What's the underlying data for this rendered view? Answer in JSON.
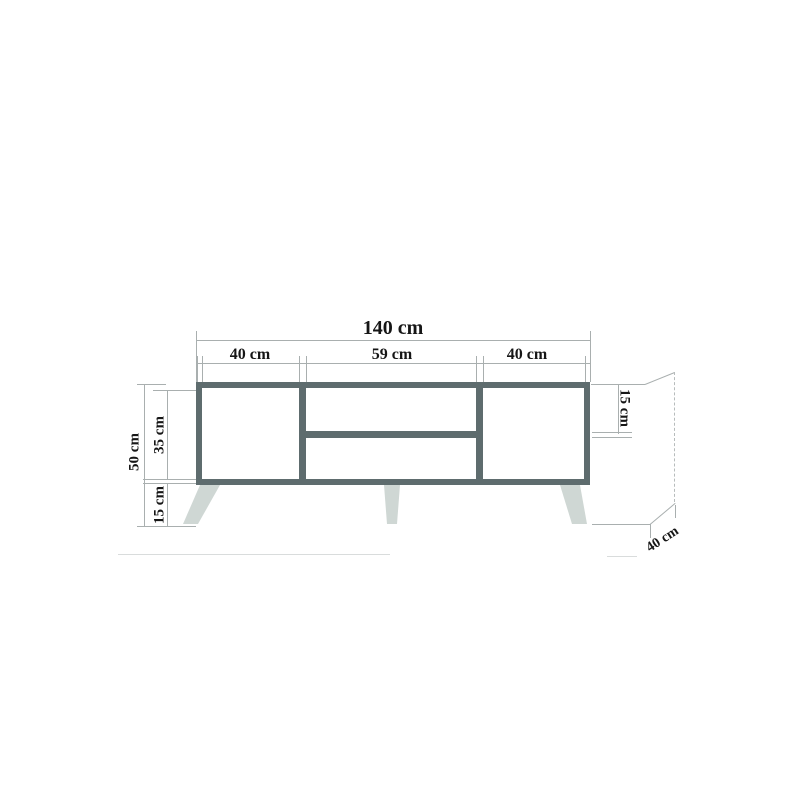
{
  "diagram": {
    "labels": {
      "total_width": "140 cm",
      "section_left": "40 cm",
      "section_middle": "59 cm",
      "section_right": "40 cm",
      "total_height": "50 cm",
      "body_height": "35 cm",
      "leg_height": "15 cm",
      "top_compartment_height": "15 cm",
      "depth": "40 cm"
    },
    "colors": {
      "body_outline": "#5e6c6e",
      "legs": "#cfd7d4",
      "dimension_lines": "#a9afaf",
      "faint_lines": "#d9dcdc",
      "text": "#161616",
      "background": "#ffffff"
    }
  }
}
